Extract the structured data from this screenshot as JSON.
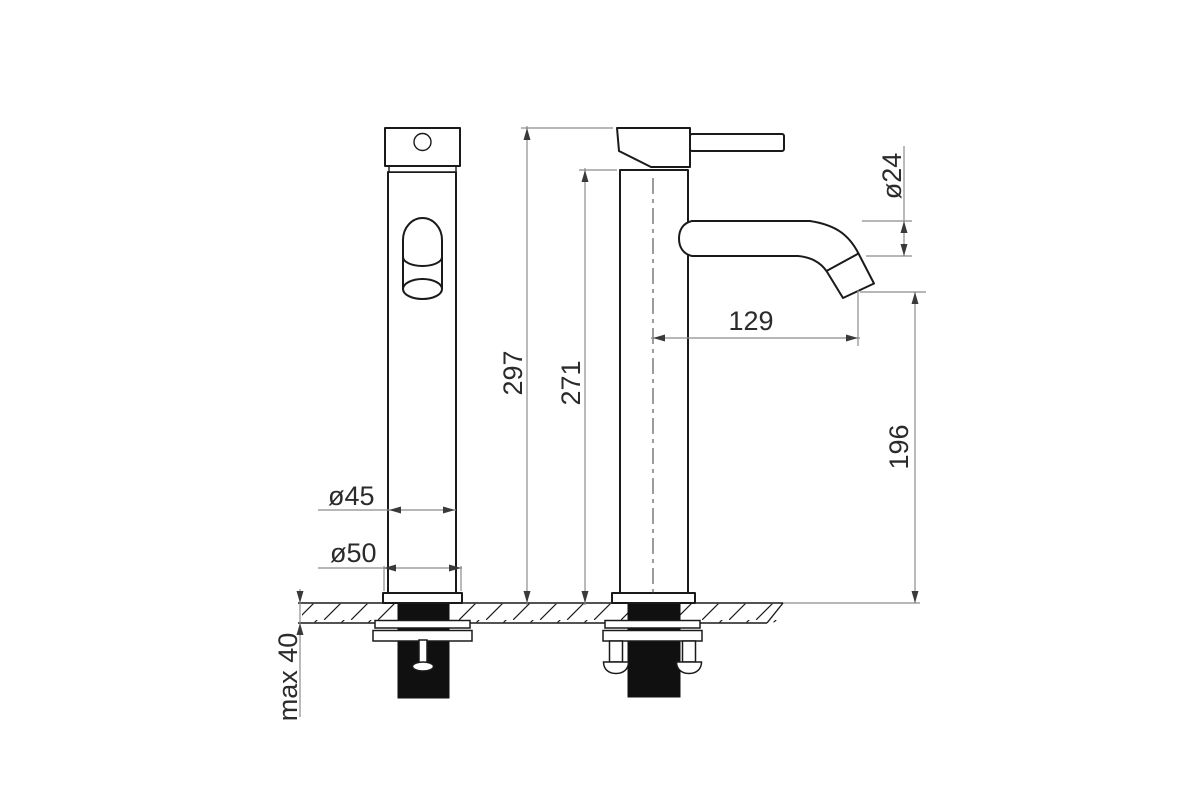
{
  "drawing": {
    "kind": "technical-drawing",
    "background": "#ffffff"
  },
  "colors": {
    "outline": "#1a1a1a",
    "dimension_line": "#8c8c8c",
    "dimension_text": "#2b2b2b",
    "thread_fill": "#101010",
    "background": "#ffffff"
  },
  "dimensions": {
    "total_height": "297",
    "body_height": "271",
    "spout_reach": "129",
    "spout_outlet_height": "196",
    "spout_diameter": "ø24",
    "body_diameter": "ø45",
    "base_diameter": "ø50",
    "max_mounting_thickness": "max 40"
  }
}
